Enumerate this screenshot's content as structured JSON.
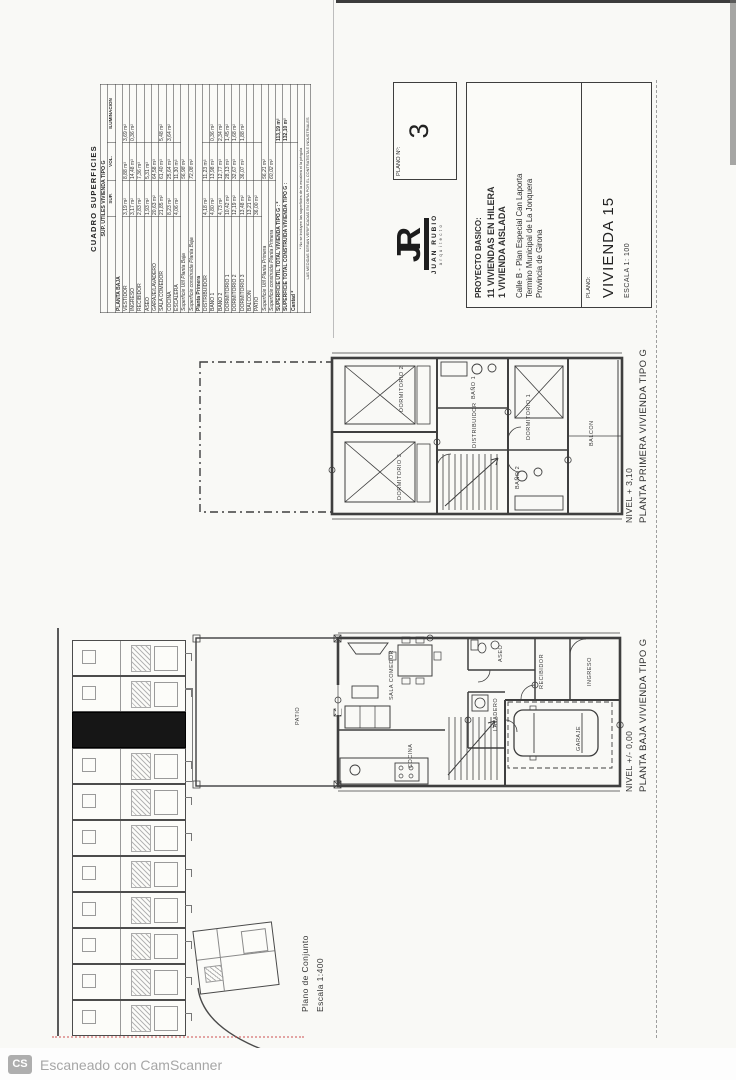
{
  "colors": {
    "ink": "#3a3a3a",
    "paper": "#f9f9f6",
    "highlight_unit": "#161616",
    "scanner_gray": "#a6a6a6"
  },
  "surface_table": {
    "title": "CUADRO SUPERFICIES",
    "header": "SUP. UTILES VIVIENDA TIPO G",
    "columns": [
      "",
      "SUP.",
      "VOL.",
      "ILUMINACION"
    ],
    "rows": [
      {
        "label": "PLANTA BAJA",
        "type": "section"
      },
      {
        "label": "VESTIDOR",
        "sup": "3,19 m²",
        "vol": "8,88 m³",
        "ilum": "3,69 m²"
      },
      {
        "label": "INGRESO",
        "sup": "3,17 m²",
        "vol": "14,48 m³",
        "ilum": "0,36 m²"
      },
      {
        "label": "RECIBIDOR",
        "sup": "2,83 m²",
        "vol": "7,36 m³",
        "ilum": ""
      },
      {
        "label": "ASEO",
        "sup": "1,93 m²",
        "vol": "5,31 m³",
        "ilum": ""
      },
      {
        "label": "GARAJE/LAVADERO",
        "sup": "20,63 m²",
        "vol": "64,58 m³",
        "ilum": ""
      },
      {
        "label": "SALA COMEDOR",
        "sup": "21,85 m²",
        "vol": "61,40 m³",
        "ilum": "5,48 m²"
      },
      {
        "label": "COCINA",
        "sup": "8,23 m²",
        "vol": "25,64 m³",
        "ilum": "3,64 m²"
      },
      {
        "label": "ESCALERA",
        "sup": "4,06 m²",
        "vol": "11,30 m³",
        "ilum": ""
      },
      {
        "label": "Superficie Util Planta Baja",
        "type": "subtotal",
        "value": "56,98 m²"
      },
      {
        "label": "Superficie construida Planta Baja",
        "type": "subtotal",
        "value": "72,08 m²"
      },
      {
        "label": "Planta Primera",
        "type": "section"
      },
      {
        "label": "DISTRIBUIDOR",
        "sup": "4,18 m²",
        "vol": "11,23 m³",
        "ilum": ""
      },
      {
        "label": "BAÑO 1",
        "sup": "4,80 m²",
        "vol": "13,98 m³",
        "ilum": "0,36 m²"
      },
      {
        "label": "BAÑO 2",
        "sup": "4,73 m²",
        "vol": "12,77 m³",
        "ilum": "2,34 m²"
      },
      {
        "label": "DORMITORIO 1",
        "sup": "10,42 m²",
        "vol": "28,13 m³",
        "ilum": "1,45 m²"
      },
      {
        "label": "DORMITORIO 2",
        "sup": "12,19 m²",
        "vol": "32,67 m³",
        "ilum": "1,68 m²"
      },
      {
        "label": "DORMITORIO 3",
        "sup": "13,48 m²",
        "vol": "36,07 m³",
        "ilum": "1,88 m²"
      },
      {
        "label": "BALCON",
        "sup": "13,21 m²",
        "vol": "",
        "ilum": ""
      },
      {
        "label": "PATIO",
        "sup": "36,00 m²",
        "vol": "",
        "ilum": ""
      },
      {
        "label": "Superficie Util Planta Primera",
        "type": "subtotal",
        "value": "56,21 m²"
      },
      {
        "label": "Superficie construida Planta Primera",
        "type": "subtotal",
        "value": "60,02 m²"
      }
    ],
    "totals": [
      {
        "label": "SUPERFICIE UTIL TOTAL VIVIENDA TIPO G : *",
        "value": "113,19 m²"
      },
      {
        "label": "SUPERFICIE TOTAL CONSTRUIDA VIVIENDA TIPO G :",
        "value": "132,10 m²"
      },
      {
        "label": "Cantad *",
        "value": ""
      }
    ],
    "footnotes": [
      "* No se incluyen las superficies de la escalera ni la pérgola",
      "LAS MEDIDAS SERAN VERIFICADAS EN OBRA POR EL CONTRATISTA E INDUSTRIALES"
    ]
  },
  "title_block": {
    "plano_n_label": "PLANO Nº:",
    "plano_n": "3",
    "logo_monogram": "JR",
    "firm_name": "JUAN RUBIO",
    "firm_role": "arquitecto",
    "project_heading": "PROYECTO BASICO:",
    "project_lines": [
      "11 VIVIENDAS EN HILERA",
      "1 VIVIENDA AISLADA"
    ],
    "address_lines": [
      "Calle B - Plan Especial Can Laporta",
      "Termino Municipal de La Jonquera",
      "Provincia de Girona"
    ],
    "plano_label": "PLANO:",
    "plano_title": "VIVIENDA 15",
    "scale": "ESCALA 1: 100"
  },
  "plan_first": {
    "level": "NIVEL + 3,10",
    "title": "PLANTA PRIMERA VIVIENDA TIPO G",
    "rooms": {
      "dormitorio2": "DORMITORIO 2",
      "dormitorio3": "DORMITORIO 3",
      "bano1": "BAÑO 1",
      "distribuidor": "DISTRIBUIDOR",
      "dormitorio1": "DORMITORIO 1",
      "bano2": "BAÑO 2",
      "balcon": "BALCON"
    }
  },
  "plan_ground": {
    "level": "NIVEL +/- 0,00",
    "title": "PLANTA BAJA VIVIENDA TIPO G",
    "rooms": {
      "patio": "PATIO",
      "sala": "SALA COMEDOR",
      "cocina": "COCINA",
      "lavadero": "LAVADERO",
      "aseo": "ASEO",
      "recibidor": "RECIBIDOR",
      "ingreso": "INGRESO",
      "garaje": "GARAJE"
    }
  },
  "site": {
    "caption1": "Plano de Conjunto",
    "caption2": "Escala 1:400",
    "row_units": 11,
    "highlighted_index": 2
  },
  "scanner": {
    "badge": "CS",
    "text": "Escaneado con CamScanner"
  }
}
